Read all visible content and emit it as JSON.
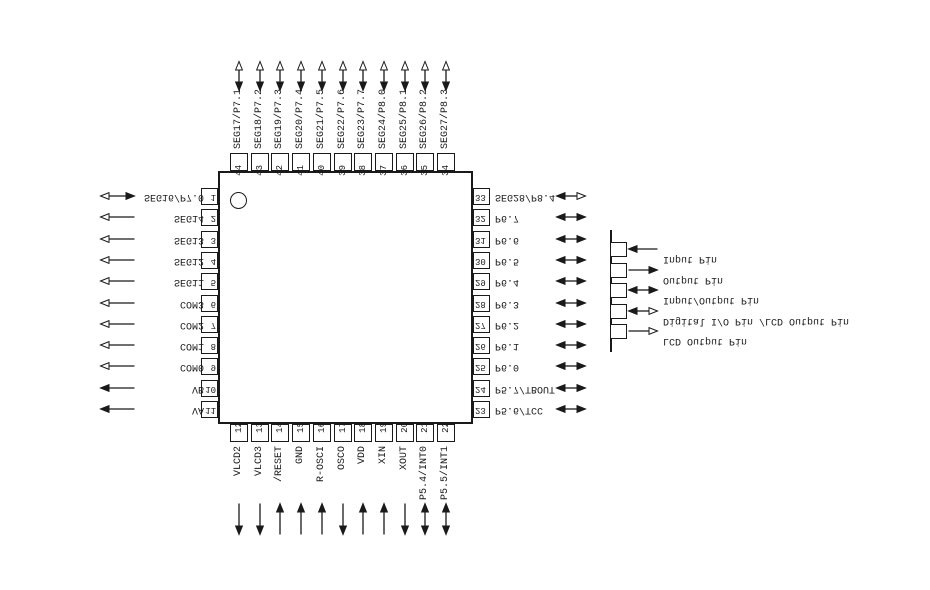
{
  "diagram": {
    "colors": {
      "line": "#1a1a1a",
      "background": "#ffffff"
    },
    "banks": {
      "top": [
        {
          "num": "44",
          "label": "SEG17/P7.1",
          "dir": "io-lcd"
        },
        {
          "num": "43",
          "label": "SEG18/P7.2",
          "dir": "io-lcd"
        },
        {
          "num": "42",
          "label": "SEG19/P7.3",
          "dir": "io-lcd"
        },
        {
          "num": "41",
          "label": "SEG20/P7.4",
          "dir": "io-lcd"
        },
        {
          "num": "40",
          "label": "SEG21/P7.5",
          "dir": "io-lcd"
        },
        {
          "num": "39",
          "label": "SEG22/P7.6",
          "dir": "io-lcd"
        },
        {
          "num": "38",
          "label": "SEG23/P7.7",
          "dir": "io-lcd"
        },
        {
          "num": "37",
          "label": "SEG24/P8.0",
          "dir": "io-lcd"
        },
        {
          "num": "36",
          "label": "SEG25/P8.1",
          "dir": "io-lcd"
        },
        {
          "num": "35",
          "label": "SEG26/P8.2",
          "dir": "io-lcd"
        },
        {
          "num": "34",
          "label": "SEG27/P8.3",
          "dir": "io-lcd"
        }
      ],
      "left": [
        {
          "num": "1",
          "label": "SEG16/P7.0",
          "dir": "io-lcd"
        },
        {
          "num": "2",
          "label": "SEG14",
          "dir": "lcd"
        },
        {
          "num": "3",
          "label": "SEG13",
          "dir": "lcd"
        },
        {
          "num": "4",
          "label": "SEG12",
          "dir": "lcd"
        },
        {
          "num": "5",
          "label": "SEG11",
          "dir": "lcd"
        },
        {
          "num": "6",
          "label": "COM3",
          "dir": "lcd"
        },
        {
          "num": "7",
          "label": "COM2",
          "dir": "lcd"
        },
        {
          "num": "8",
          "label": "COM1",
          "dir": "lcd"
        },
        {
          "num": "9",
          "label": "COM0",
          "dir": "lcd"
        },
        {
          "num": "10",
          "label": "VB",
          "dir": "out"
        },
        {
          "num": "11",
          "label": "VA",
          "dir": "out"
        }
      ],
      "right": [
        {
          "num": "33",
          "label": "SEG28/P8.4",
          "dir": "io-lcd"
        },
        {
          "num": "32",
          "label": "P6.7",
          "dir": "io"
        },
        {
          "num": "31",
          "label": "P6.6",
          "dir": "io"
        },
        {
          "num": "30",
          "label": "P6.5",
          "dir": "io"
        },
        {
          "num": "29",
          "label": "P6.4",
          "dir": "io"
        },
        {
          "num": "28",
          "label": "P6.3",
          "dir": "io"
        },
        {
          "num": "27",
          "label": "P6.2",
          "dir": "io"
        },
        {
          "num": "26",
          "label": "P6.1",
          "dir": "io"
        },
        {
          "num": "25",
          "label": "P6.0",
          "dir": "io"
        },
        {
          "num": "24",
          "label": "P5.7/TBOUT",
          "dir": "io"
        },
        {
          "num": "23",
          "label": "P5.6/TCC",
          "dir": "io"
        }
      ],
      "bottom": [
        {
          "num": "12",
          "label": "VLCD2",
          "dir": "out"
        },
        {
          "num": "13",
          "label": "VLCD3",
          "dir": "out"
        },
        {
          "num": "14",
          "label": "/RESET",
          "dir": "in"
        },
        {
          "num": "15",
          "label": "GND",
          "dir": "in"
        },
        {
          "num": "16",
          "label": "R-OSCI",
          "dir": "in"
        },
        {
          "num": "17",
          "label": "OSCO",
          "dir": "out"
        },
        {
          "num": "18",
          "label": "VDD",
          "dir": "in"
        },
        {
          "num": "19",
          "label": "XIN",
          "dir": "in"
        },
        {
          "num": "20",
          "label": "XOUT",
          "dir": "out"
        },
        {
          "num": "21",
          "label": "P5.4/INT0",
          "dir": "io"
        },
        {
          "num": "22",
          "label": "P5.5/INT1",
          "dir": "io"
        }
      ]
    },
    "legend": [
      {
        "label": "Input Pin",
        "dir": "in"
      },
      {
        "label": "Output Pin",
        "dir": "out"
      },
      {
        "label": "Input/Output Pin",
        "dir": "io"
      },
      {
        "label": "Digital I/O Pin /LCD Output Pin",
        "dir": "io-lcd"
      },
      {
        "label": "LCD Output Pin",
        "dir": "lcd"
      }
    ]
  }
}
